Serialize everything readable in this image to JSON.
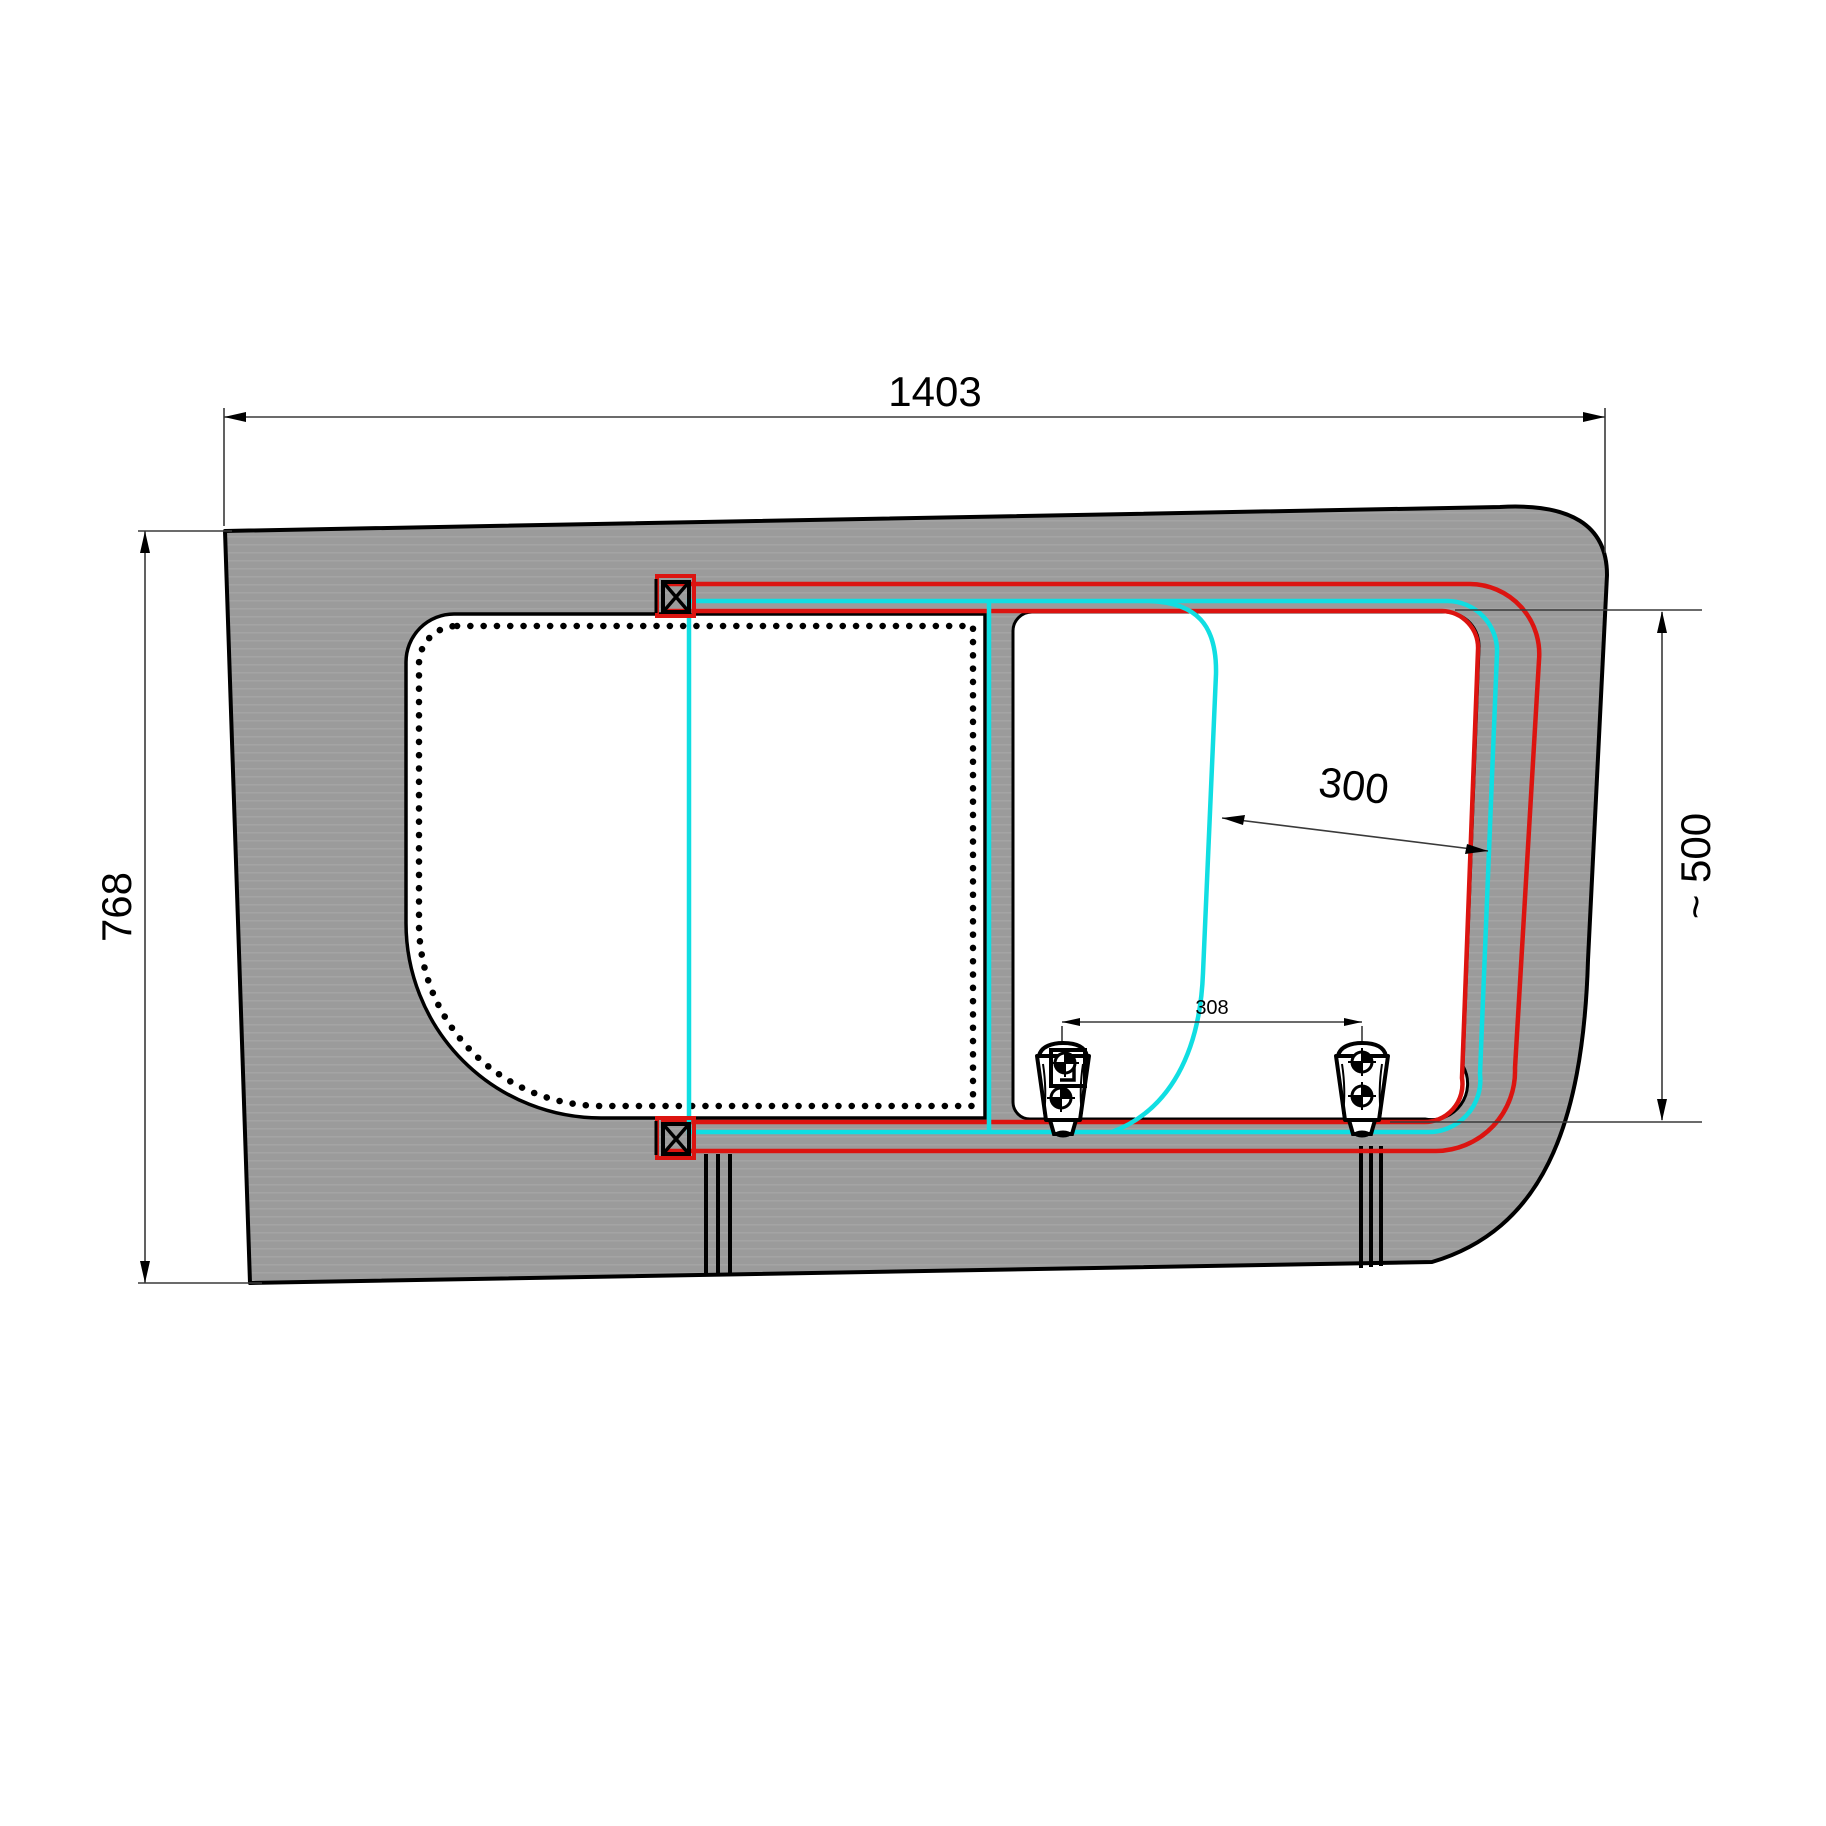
{
  "drawing": {
    "kind": "technical-drawing",
    "subject": "Van side panel sliding window installation drawing",
    "labels": {
      "overall_width": "1403",
      "overall_height": "768",
      "opening_width": "300",
      "window_height": "~ 500",
      "latch_spacing": "308"
    },
    "colors": {
      "frame-red": "#dc1410",
      "glass-cyan": "#10dee2",
      "panel-gray": "#9b9b9b",
      "panel-band": "#a4a4a4",
      "line-black": "#000000",
      "dim-gray": "#3a3a3a",
      "background": "#ffffff"
    }
  }
}
